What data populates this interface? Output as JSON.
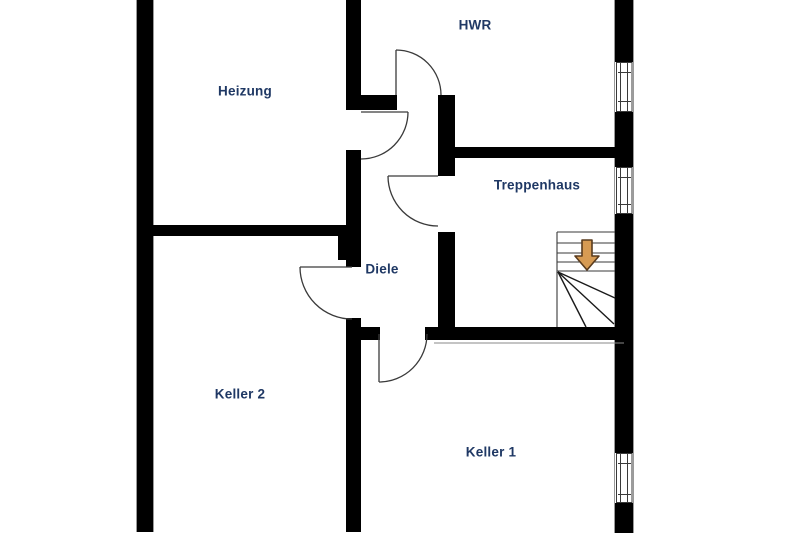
{
  "plan": {
    "type": "floor-plan",
    "level": "basement",
    "rooms": [
      {
        "id": "heizung",
        "label": "Heizung"
      },
      {
        "id": "hwr",
        "label": "HWR"
      },
      {
        "id": "treppenhaus",
        "label": "Treppenhaus"
      },
      {
        "id": "diele",
        "label": "Diele"
      },
      {
        "id": "keller2",
        "label": "Keller 2"
      },
      {
        "id": "keller1",
        "label": "Keller 1"
      }
    ],
    "stairs": {
      "direction": "down",
      "icon": "stair-direction-down-arrow",
      "winder_steps": true
    },
    "counts": {
      "doors": 5,
      "windows": 3
    },
    "colors": {
      "background": "#FFFFFF",
      "wall": "#000000",
      "label_text": "#1F3864",
      "arrow_fill": "#D79B53",
      "arrow_outline": "#5A3C1E",
      "thin_line": "#444444"
    }
  }
}
